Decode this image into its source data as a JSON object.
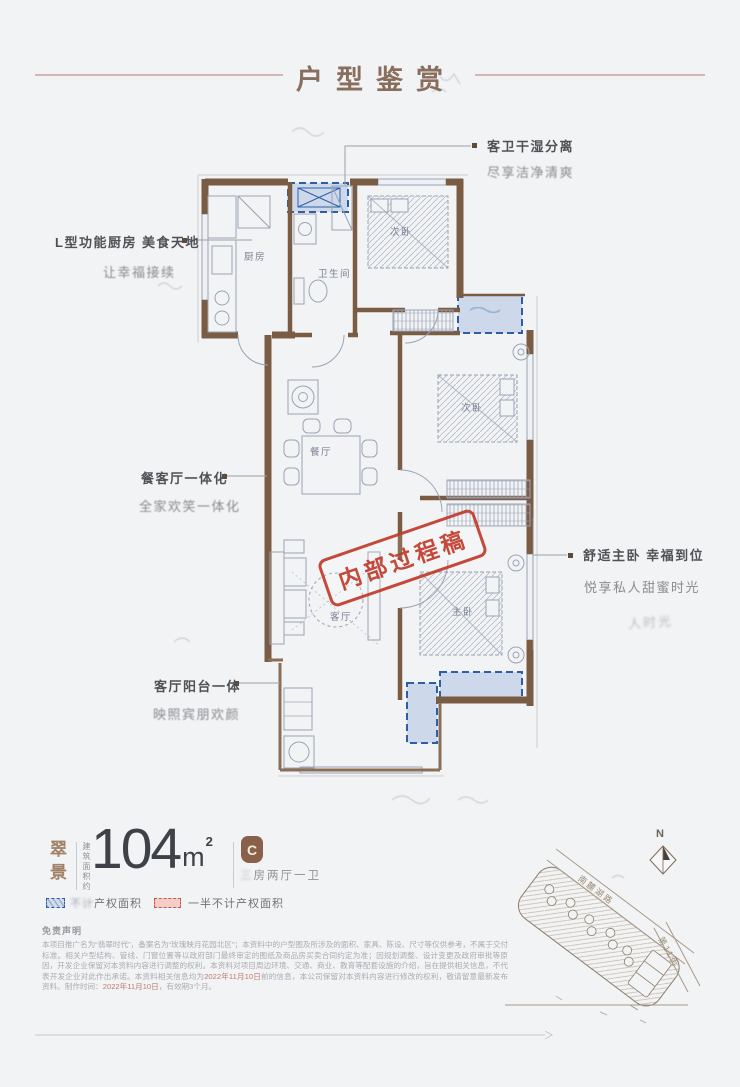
{
  "header": {
    "title": "户型鉴赏"
  },
  "callouts": {
    "bath": {
      "line1": "客卫干湿分离",
      "line2": "尽享洁净清爽"
    },
    "kitchen": {
      "line1": "L型功能厨房 美食天地",
      "line2": "让幸福接续"
    },
    "dining": {
      "line1": "餐客厅一体化",
      "line2": "全家欢笑一体化"
    },
    "balcony": {
      "line1": "客厅阳台一体",
      "line2": "映照宾朋欢颜"
    },
    "master": {
      "line1": "舒适主卧 幸福到位",
      "line2": "悦享私人甜蜜时光",
      "ghost": "人时光"
    }
  },
  "stamp": {
    "text": "内部过程稿",
    "color": "#c23b2b"
  },
  "plan": {
    "rooms": [
      {
        "label": "厨房"
      },
      {
        "label": "卫生间"
      },
      {
        "label": "次卧"
      },
      {
        "label": "次卧"
      },
      {
        "label": "餐厅"
      },
      {
        "label": "客厅"
      },
      {
        "label": "主卧"
      }
    ]
  },
  "info": {
    "project": "翠景",
    "area_note": "建筑面积约",
    "area": "104",
    "unit": "m",
    "sup": "2",
    "badge": "C",
    "layout_prefix": "三",
    "layout": "房两厅一卫"
  },
  "legend": {
    "blue_prefix": "不计",
    "blue_label": "产权面积",
    "red_label": "一半不计产权面积",
    "blue_color": "#2e5ea6",
    "red_color": "#cf5548"
  },
  "disclaimer": {
    "heading": "免责声明",
    "p1": "本项目推广名为“翡翠时代”，备案名为“玫瑰映月花园北区”；本资料中的户型图及所涉及的面积、家具、陈设、尺寸等仅供参考，不属于交付标准。相关户型结构、管线、门窗位置等以政府部门最终审定的图纸及商品房买卖合同约定为准；因规划调整、设计变更及政府审批等原因，开发企业保留对本资料内容进行调整的权利。本资料对项目周边环境、交通、商业、教育等配套设施的介绍，旨在提供相关信息，不代表开发企业对此作出承诺。本资料相关信息均为",
    "red1": "2022年11月10日",
    "p2": "前的信息，本公司保留对本资料内容进行修改的权利，敬请留意最新发布资料。制作时间：",
    "red2": "2022年11月10日",
    "p3": "，有效期3个月。"
  },
  "site": {
    "compass": "N",
    "road1": "南麓湖路",
    "road2": "第11街"
  },
  "colors": {
    "accent_brown": "#8a6e5d",
    "wall": "#7a5c45",
    "plan_line": "#9aa3b5"
  }
}
